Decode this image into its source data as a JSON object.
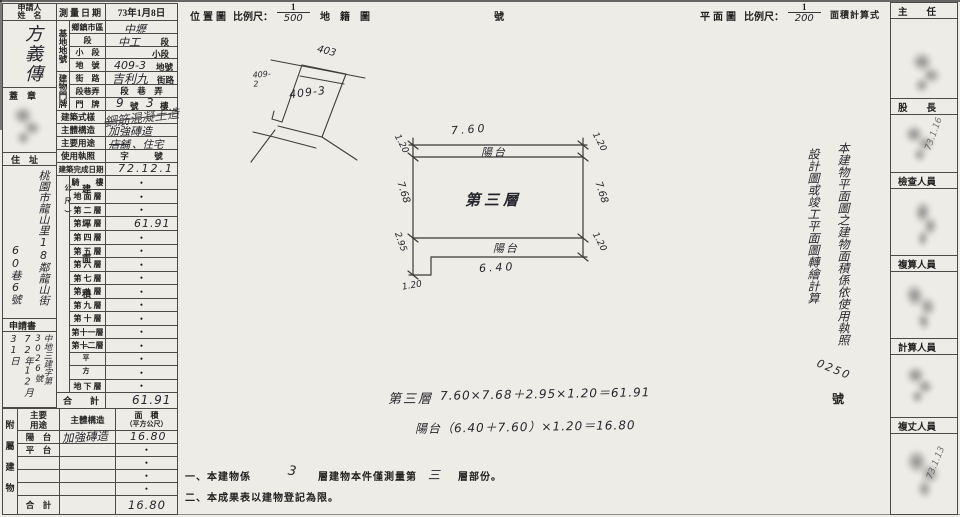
{
  "form": {
    "applicant": {
      "label1": "申請人",
      "label2": "姓　名",
      "name": "方義傳"
    },
    "survey_date": {
      "label": "測量日期",
      "value": "73年1月8日"
    },
    "seal": {
      "label": "蓋　章"
    },
    "address": {
      "label": "住　址",
      "line1": "桃園市龍山里18鄰龍山街",
      "line2": "60巷6號"
    },
    "application": {
      "label": "申請書",
      "number": "中地三建字第3026號",
      "date": "72年12月31日"
    },
    "site": {
      "group": "基地地號",
      "rows": [
        {
          "label": "鄉鎮市區",
          "value": "中壢",
          "suffix": ""
        },
        {
          "label": "段",
          "value": "中工",
          "suffix": "段"
        },
        {
          "label": "小　段",
          "value": "",
          "suffix": "小段"
        },
        {
          "label": "地　號",
          "value": "409-3",
          "suffix": "地號"
        }
      ]
    },
    "door": {
      "group": "建物門牌",
      "rows": [
        {
          "label": "街　路",
          "value": "吉利九",
          "suffix": "街路"
        },
        {
          "label": "段巷弄",
          "value": "",
          "suffix": "段　巷　弄"
        },
        {
          "label": "門　牌",
          "value": "9",
          "suffix": "號",
          "value2": "3",
          "suffix2": "樓"
        }
      ]
    },
    "style": {
      "label": "建築式樣",
      "value": "鋼筋混凝土造"
    },
    "structure": {
      "label": "主體構造",
      "value": "加強磚造"
    },
    "usage": {
      "label": "主要用途",
      "struck": "店舖",
      "rest": "、住宅"
    },
    "license": {
      "label": "使用執照",
      "value": "字　　　號"
    },
    "completion": {
      "label": "建築完成日期",
      "value": "72.12.1"
    },
    "areas": {
      "group": "建坪面積",
      "group_unit": "（平方公尺）",
      "rows": [
        {
          "label": "騎　　樓",
          "value": "•"
        },
        {
          "label": "地 面 層",
          "value": "•"
        },
        {
          "label": "第 二 層",
          "value": "•"
        },
        {
          "label": "第 三 層",
          "value": "61.91"
        },
        {
          "label": "第 四 層",
          "value": "•"
        },
        {
          "label": "第 五 層",
          "value": "•"
        },
        {
          "label": "第 六 層",
          "value": "•"
        },
        {
          "label": "第 七 層",
          "value": "•"
        },
        {
          "label": "第 八 層",
          "value": "•"
        },
        {
          "label": "第 九 層",
          "value": "•"
        },
        {
          "label": "第 十 層",
          "value": "•"
        },
        {
          "label": "第十一層",
          "value": "•"
        },
        {
          "label": "第十二層",
          "value": "•"
        },
        {
          "label": "",
          "value": "•"
        },
        {
          "label": "",
          "value": "•"
        },
        {
          "label": "地 下 層",
          "value": "•"
        }
      ],
      "total": {
        "label": "合　　計",
        "value": "61.91"
      }
    },
    "annex": {
      "group": "附屬建物",
      "headers": {
        "use": "主要用途",
        "structure": "主體構造",
        "area1": "面　積",
        "area2": "（平方公尺）"
      },
      "rows": [
        {
          "use": "陽　台",
          "structure": "加強磚造",
          "area": "16.80"
        },
        {
          "use": "平　台",
          "structure": "",
          "area": "•"
        },
        {
          "use": "",
          "structure": "",
          "area": "•"
        },
        {
          "use": "",
          "structure": "",
          "area": "•"
        },
        {
          "use": "",
          "structure": "",
          "area": "•"
        }
      ],
      "total": {
        "use": "合　計",
        "area": "16.80"
      }
    }
  },
  "location_map": {
    "title": "位置圖",
    "scale_label": "比例尺：",
    "scale_num": "1",
    "scale_den": "500",
    "map_label": "地　籍　圖",
    "number_suffix": "號",
    "parcel_main": "409-3",
    "parcel_top": "403",
    "parcel_left": "409-2"
  },
  "floor_plan": {
    "title": "平面圖",
    "scale_label": "比例尺：",
    "scale_num": "1",
    "scale_den": "200",
    "calc_label": "面積計算式",
    "room": "第三層",
    "balcony_top": "陽台",
    "balcony_bottom": "陽台",
    "dims": {
      "top": "7.60",
      "left": "7.68",
      "right": "7.68",
      "top_left": "1.20",
      "top_right": "1.20",
      "bottom_right": "1.20",
      "bottom": "6.40",
      "notch_left": "2.95",
      "notch_bottom": "1.20"
    }
  },
  "calc_note": {
    "col_right": "本建物平面圖之建物面積係依使用執照",
    "col_left": "設計圖或竣工平面圖轉繪計算",
    "license_no": "0250",
    "suffix": "號"
  },
  "formulas": {
    "floor_label": "第三層",
    "floor_expr": "7.60×7.68＋2.95×1.20＝61.91",
    "balcony_expr": "陽台（6.40＋7.60）×1.20＝16.80"
  },
  "footnotes": {
    "n1_pre": "一、本建物係",
    "n1_num": "3",
    "n1_mid": "層建物本件僅測量第",
    "n1_num2": "三",
    "n1_post": "層部份。",
    "n2": "二、本成果表以建物登記為限。"
  },
  "signoff": {
    "sections": [
      {
        "title": "主　　任",
        "note": ""
      },
      {
        "title": "股　　長",
        "note": "73.1.16"
      },
      {
        "title": "檢查人員",
        "note": ""
      },
      {
        "title": "複算人員",
        "note": ""
      },
      {
        "title": "計算人員",
        "note": ""
      },
      {
        "title": "複丈人員",
        "note": "73.1.13"
      }
    ]
  }
}
